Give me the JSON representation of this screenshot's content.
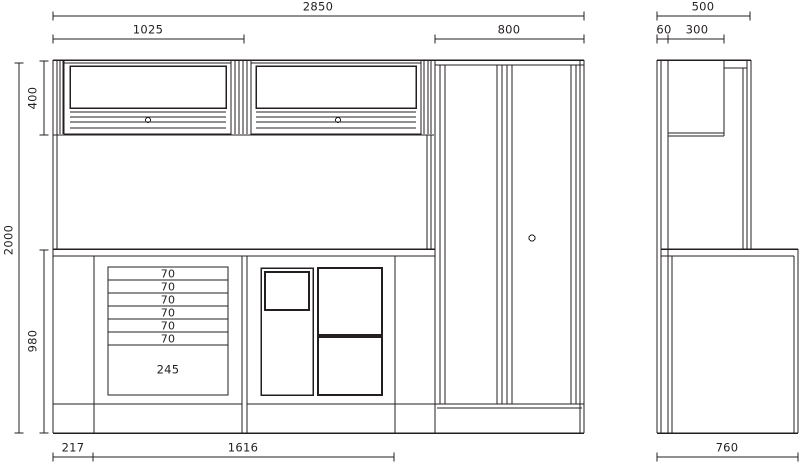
{
  "drawing": {
    "type": "furniture workshop system - dimensioned front and side elevation",
    "line_color": "#231f20",
    "background": "#ffffff"
  },
  "dimensions": {
    "top": {
      "overall_width": "2850",
      "left_wall_cabinet_width": "1025",
      "tall_cabinet_width": "800"
    },
    "side_top": {
      "overall_depth": "500",
      "wall_panel_depth": "60",
      "wall_cabinet_depth": "300"
    },
    "left": {
      "overall_height": "2000",
      "wall_cabinet_height": "400",
      "bench_height": "980"
    },
    "bottom": {
      "left_offset": "217",
      "bench_width": "1616",
      "side_bench_depth": "760"
    },
    "drawers": {
      "rows": [
        "70",
        "70",
        "70",
        "70",
        "70",
        "70"
      ],
      "bottom_compartment": "245"
    }
  }
}
